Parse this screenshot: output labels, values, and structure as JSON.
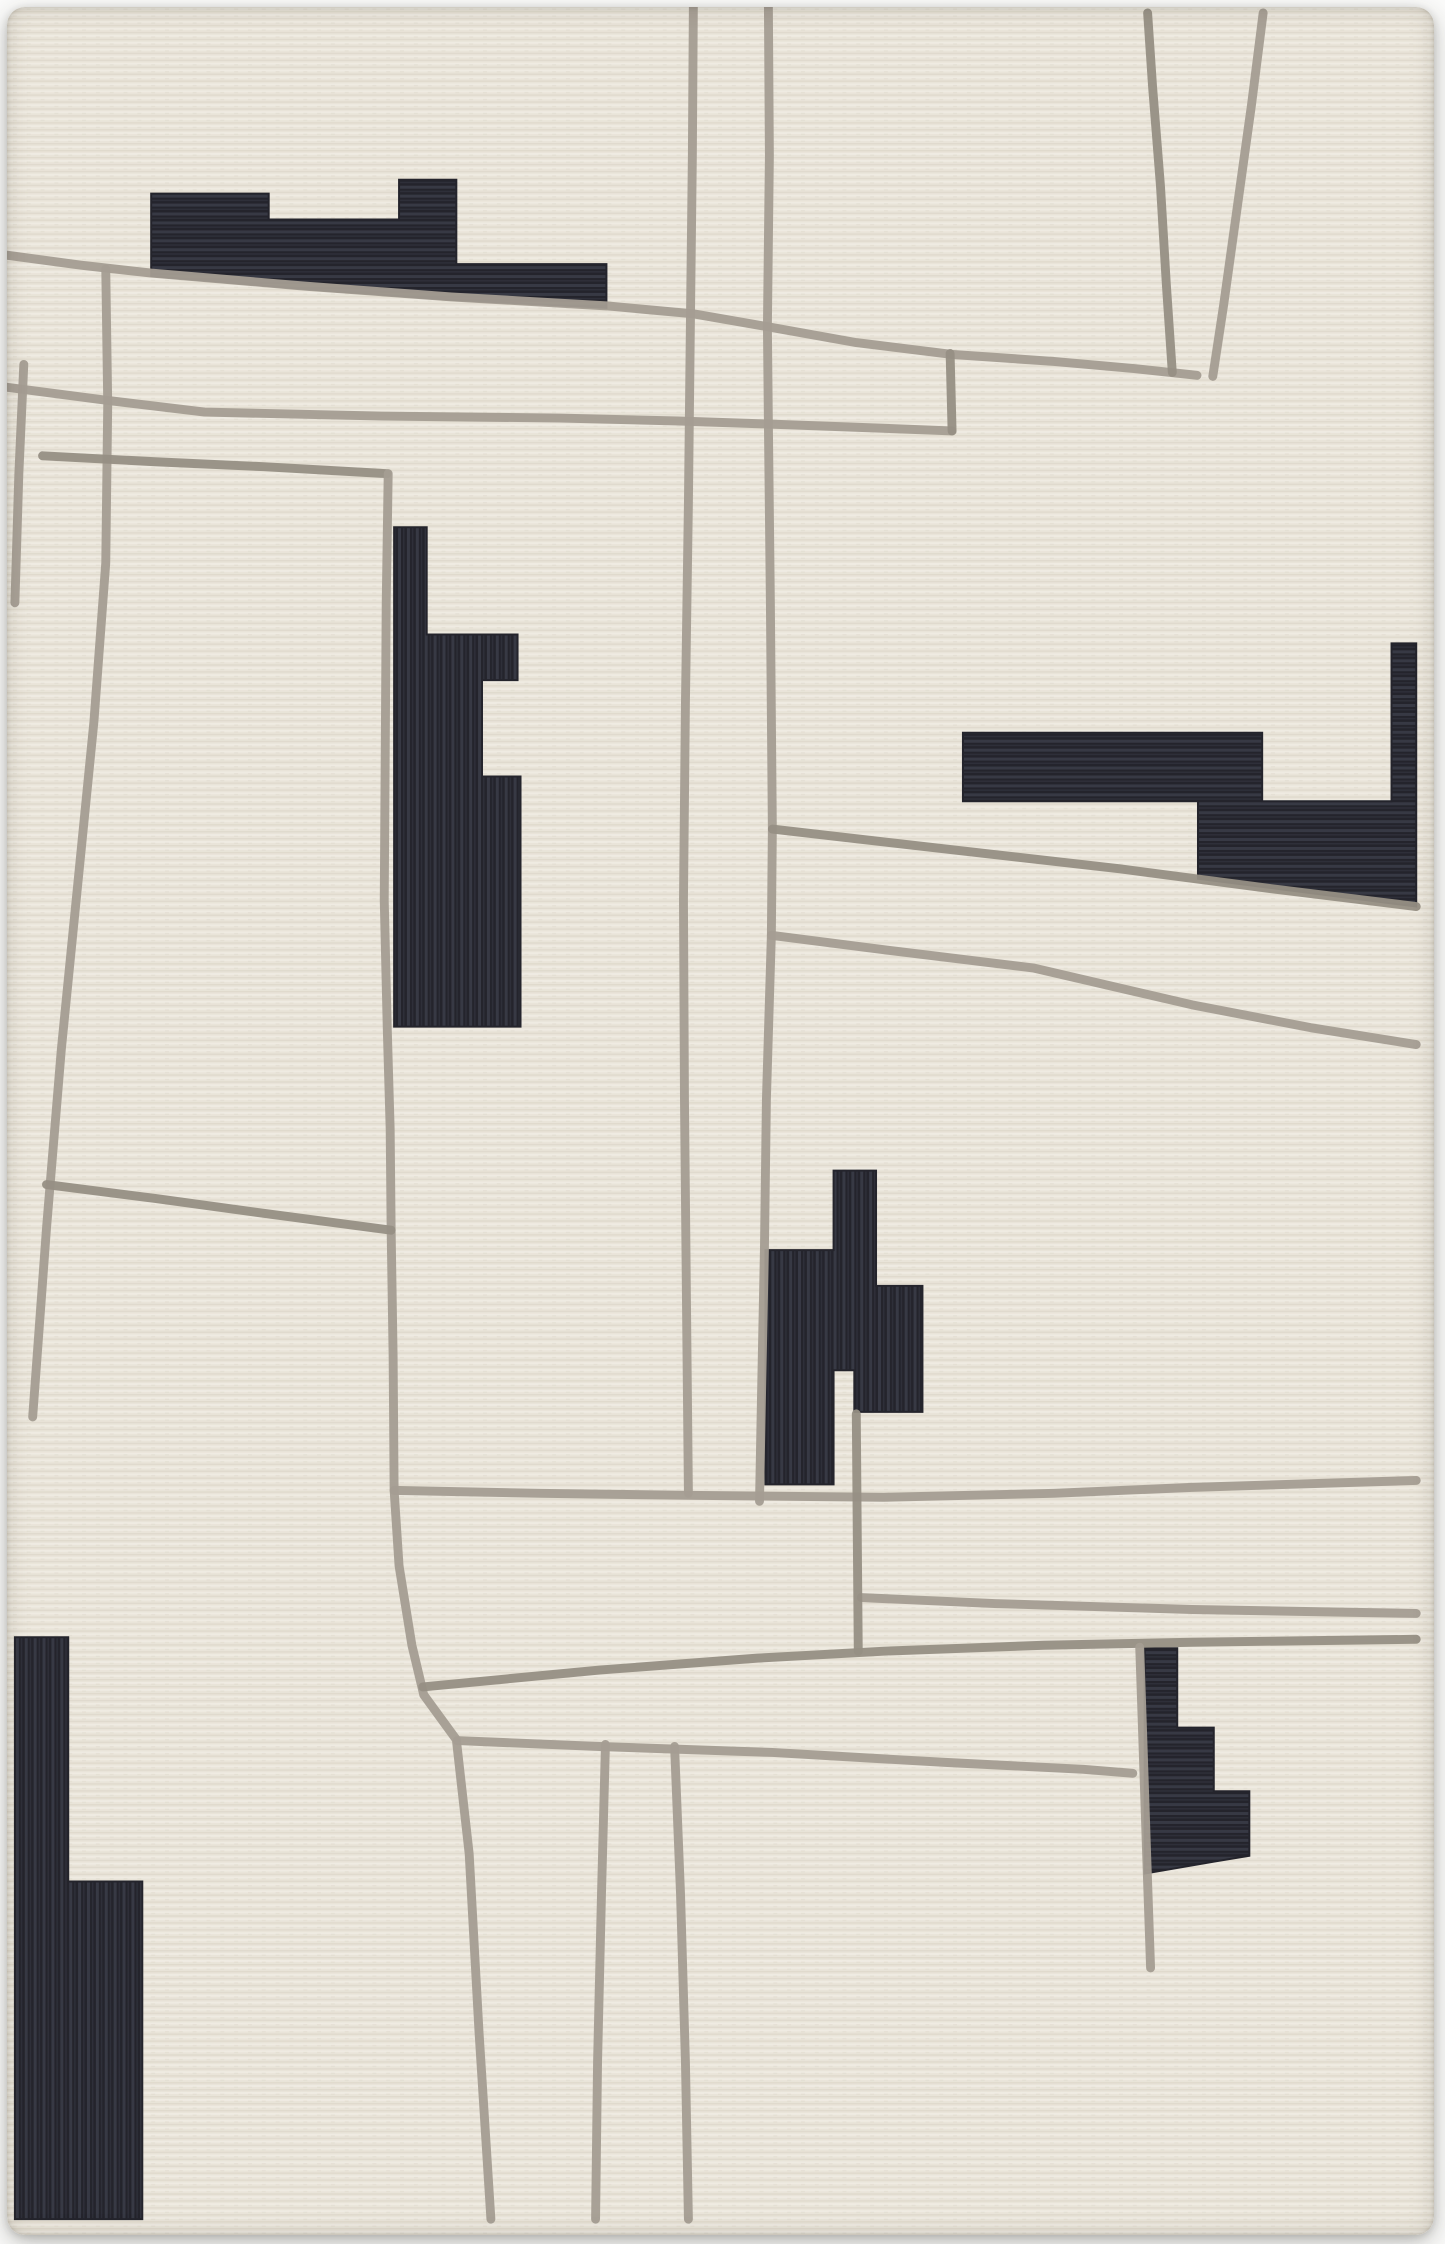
{
  "photo": {
    "subject": "abstract-wool-area-rug",
    "background_color": "#fbfbfa",
    "rug": {
      "base_color": "#e9e4d9",
      "weave_highlight": "#f3efe6",
      "weave_shadow": "#ddd7ca",
      "line_color": "#a49d92",
      "line_color_dark": "#968f84",
      "line_width": 9,
      "shape_color": "#24242c",
      "shape_rib_color": "#474a57",
      "view_width": 1445,
      "view_height": 2244
    },
    "gray_lines": [
      {
        "name": "gray-line-top-diagonal",
        "points": [
          [
            0,
            250
          ],
          [
            75,
            260
          ],
          [
            146,
            268
          ],
          [
            300,
            281
          ],
          [
            450,
            292
          ],
          [
            607,
            301
          ],
          [
            695,
            309
          ],
          [
            770,
            322
          ],
          [
            860,
            338
          ],
          [
            958,
            350
          ],
          [
            1060,
            357
          ],
          [
            1140,
            364
          ],
          [
            1205,
            371
          ]
        ]
      },
      {
        "name": "gray-line-top-right-v-left-branch",
        "points": [
          [
            1155,
            6
          ],
          [
            1160,
            80
          ],
          [
            1168,
            180
          ],
          [
            1174,
            280
          ],
          [
            1180,
            368
          ]
        ]
      },
      {
        "name": "gray-line-top-right-v-right-branch",
        "points": [
          [
            1272,
            6
          ],
          [
            1260,
            100
          ],
          [
            1246,
            200
          ],
          [
            1232,
            300
          ],
          [
            1221,
            372
          ]
        ]
      },
      {
        "name": "gray-line-upper-horizontal",
        "points": [
          [
            0,
            383
          ],
          [
            100,
            396
          ],
          [
            200,
            408
          ],
          [
            380,
            412
          ],
          [
            560,
            414
          ],
          [
            680,
            417
          ],
          [
            770,
            420
          ],
          [
            880,
            424
          ],
          [
            957,
            427
          ]
        ]
      },
      {
        "name": "gray-line-upper-connector-stub",
        "points": [
          [
            955,
            349
          ],
          [
            957,
            427
          ]
        ]
      },
      {
        "name": "gray-line-vertical-center-long",
        "points": [
          [
            695,
            0
          ],
          [
            694,
            150
          ],
          [
            692,
            320
          ],
          [
            690,
            500
          ],
          [
            687,
            700
          ],
          [
            685,
            900
          ],
          [
            686,
            1100
          ],
          [
            688,
            1300
          ],
          [
            690,
            1497
          ]
        ]
      },
      {
        "name": "gray-line-vertical-right-long",
        "points": [
          [
            771,
            0
          ],
          [
            772,
            150
          ],
          [
            770,
            322
          ],
          [
            771,
            420
          ],
          [
            773,
            600
          ],
          [
            775,
            828
          ],
          [
            774,
            935
          ],
          [
            769,
            1100
          ],
          [
            767,
            1250
          ],
          [
            764,
            1400
          ],
          [
            762,
            1505
          ]
        ]
      },
      {
        "name": "gray-line-right-fan-diagonal-upper",
        "points": [
          [
            775,
            828
          ],
          [
            950,
            848
          ],
          [
            1127,
            868
          ],
          [
            1280,
            888
          ],
          [
            1427,
            906
          ]
        ]
      },
      {
        "name": "gray-line-right-fan-diagonal-lower",
        "points": [
          [
            774,
            935
          ],
          [
            900,
            951
          ],
          [
            1040,
            968
          ],
          [
            1200,
            1005
          ],
          [
            1320,
            1028
          ],
          [
            1427,
            1045
          ]
        ]
      },
      {
        "name": "gray-line-left-trapezoid-edge",
        "points": [
          [
            100,
            264
          ],
          [
            102,
            400
          ],
          [
            100,
            560
          ],
          [
            88,
            720
          ],
          [
            70,
            900
          ],
          [
            55,
            1050
          ],
          [
            40,
            1230
          ],
          [
            26,
            1420
          ]
        ]
      },
      {
        "name": "gray-line-left-short-horizontal",
        "points": [
          [
            36,
            452
          ],
          [
            150,
            458
          ],
          [
            260,
            463
          ],
          [
            385,
            470
          ]
        ]
      },
      {
        "name": "gray-line-left-rug-edge-accent",
        "points": [
          [
            17,
            360
          ],
          [
            12,
            470
          ],
          [
            8,
            600
          ]
        ]
      },
      {
        "name": "gray-line-mid-vertical-with-bend",
        "points": [
          [
            386,
            470
          ],
          [
            384,
            600
          ],
          [
            383,
            750
          ],
          [
            382,
            900
          ],
          [
            385,
            1027
          ],
          [
            388,
            1130
          ],
          [
            389,
            1233
          ],
          [
            391,
            1360
          ],
          [
            392,
            1494
          ],
          [
            397,
            1570
          ],
          [
            410,
            1650
          ],
          [
            422,
            1700
          ],
          [
            455,
            1745
          ],
          [
            468,
            1860
          ],
          [
            478,
            2040
          ],
          [
            490,
            2228
          ]
        ]
      },
      {
        "name": "gray-line-left-lower-horizontal",
        "points": [
          [
            40,
            1186
          ],
          [
            150,
            1200
          ],
          [
            260,
            1215
          ],
          [
            389,
            1232
          ]
        ]
      },
      {
        "name": "gray-line-band-horizontal-1",
        "points": [
          [
            392,
            1494
          ],
          [
            540,
            1497
          ],
          [
            690,
            1499
          ],
          [
            888,
            1501
          ],
          [
            1060,
            1497
          ],
          [
            1200,
            1491
          ],
          [
            1427,
            1484
          ]
        ]
      },
      {
        "name": "gray-line-band-horizontal-2",
        "points": [
          [
            865,
            1602
          ],
          [
            1000,
            1608
          ],
          [
            1200,
            1614
          ],
          [
            1427,
            1618
          ]
        ]
      },
      {
        "name": "gray-line-band-horizontal-3",
        "points": [
          [
            421,
            1692
          ],
          [
            600,
            1675
          ],
          [
            760,
            1663
          ],
          [
            888,
            1656
          ],
          [
            1050,
            1650
          ],
          [
            1200,
            1647
          ],
          [
            1427,
            1644
          ]
        ]
      },
      {
        "name": "gray-line-band-horizontal-4",
        "points": [
          [
            456,
            1746
          ],
          [
            600,
            1752
          ],
          [
            775,
            1758
          ],
          [
            950,
            1768
          ],
          [
            1090,
            1775
          ],
          [
            1140,
            1779
          ]
        ]
      },
      {
        "name": "gray-line-bottom-right-hanger",
        "points": [
          [
            1147,
            1652
          ],
          [
            1150,
            1740
          ],
          [
            1154,
            1860
          ],
          [
            1158,
            1975
          ]
        ]
      },
      {
        "name": "gray-line-center-connector-vertical",
        "points": [
          [
            860,
            1417
          ],
          [
            861,
            1540
          ],
          [
            862,
            1656
          ]
        ]
      },
      {
        "name": "gray-line-bottom-vertical-left",
        "points": [
          [
            606,
            1750
          ],
          [
            602,
            1900
          ],
          [
            598,
            2070
          ],
          [
            596,
            2228
          ]
        ]
      },
      {
        "name": "gray-line-bottom-vertical-right",
        "points": [
          [
            676,
            1752
          ],
          [
            682,
            1900
          ],
          [
            687,
            2070
          ],
          [
            690,
            2228
          ]
        ]
      }
    ],
    "black_shapes": [
      {
        "name": "black-shape-top-left",
        "rib": "horizontal",
        "points": [
          [
            146,
            188
          ],
          [
            265,
            188
          ],
          [
            265,
            214
          ],
          [
            397,
            214
          ],
          [
            397,
            174
          ],
          [
            455,
            174
          ],
          [
            455,
            259
          ],
          [
            607,
            259
          ],
          [
            607,
            303
          ],
          [
            450,
            295
          ],
          [
            300,
            284
          ],
          [
            146,
            271
          ]
        ]
      },
      {
        "name": "black-shape-middle-left",
        "rib": "vertical",
        "points": [
          [
            392,
            524
          ],
          [
            425,
            524
          ],
          [
            425,
            632
          ],
          [
            517,
            632
          ],
          [
            517,
            678
          ],
          [
            481,
            678
          ],
          [
            481,
            775
          ],
          [
            520,
            775
          ],
          [
            520,
            1027
          ],
          [
            392,
            1027
          ]
        ]
      },
      {
        "name": "black-shape-right",
        "rib": "horizontal",
        "points": [
          [
            968,
            731
          ],
          [
            1271,
            731
          ],
          [
            1271,
            800
          ],
          [
            1402,
            800
          ],
          [
            1402,
            641
          ],
          [
            1427,
            641
          ],
          [
            1427,
            906
          ],
          [
            1206,
            878
          ],
          [
            1206,
            800
          ],
          [
            968,
            800
          ]
        ]
      },
      {
        "name": "black-shape-center-bottom",
        "rib": "vertical",
        "points": [
          [
            837,
            1172
          ],
          [
            880,
            1172
          ],
          [
            880,
            1288
          ],
          [
            927,
            1288
          ],
          [
            927,
            1415
          ],
          [
            858,
            1415
          ],
          [
            858,
            1373
          ],
          [
            837,
            1373
          ],
          [
            837,
            1488
          ],
          [
            768,
            1488
          ],
          [
            768,
            1252
          ],
          [
            837,
            1252
          ]
        ]
      },
      {
        "name": "black-shape-bottom-left",
        "rib": "vertical",
        "points": [
          [
            8,
            1642
          ],
          [
            62,
            1642
          ],
          [
            62,
            1888
          ],
          [
            137,
            1888
          ],
          [
            137,
            2228
          ],
          [
            8,
            2228
          ]
        ]
      },
      {
        "name": "black-shape-bottom-right",
        "rib": "horizontal",
        "points": [
          [
            1152,
            1653
          ],
          [
            1185,
            1653
          ],
          [
            1185,
            1733
          ],
          [
            1222,
            1733
          ],
          [
            1222,
            1797
          ],
          [
            1258,
            1797
          ],
          [
            1258,
            1862
          ],
          [
            1222,
            1868
          ],
          [
            1152,
            1880
          ]
        ]
      }
    ]
  }
}
